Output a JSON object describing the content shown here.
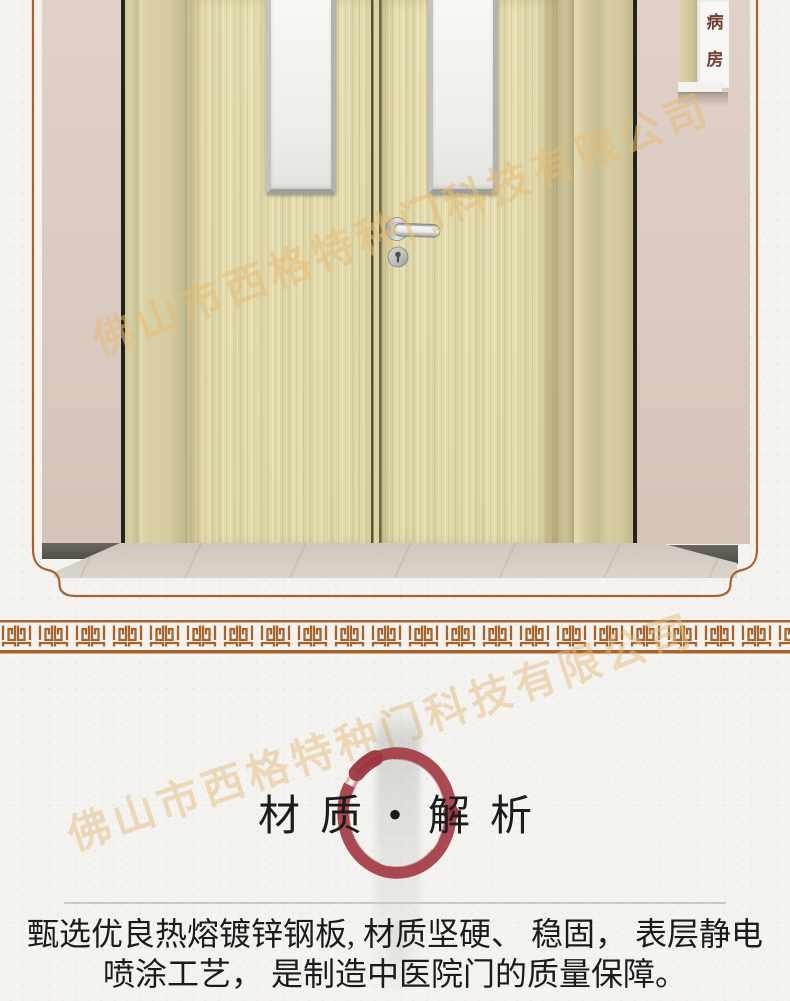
{
  "photo": {
    "room_sign": "病房",
    "watermark_text": "佛山市西格特种门科技有限公司"
  },
  "material_section": {
    "heading_left": "材质",
    "heading_dot": "•",
    "heading_right": "解析",
    "paragraph_line1": "甄选优良热熔镀锌钢板, 材质坚硬、 稳固， 表层静电",
    "paragraph_line2": "喷涂工艺， 是制造中医院门的质量保障。"
  },
  "colors": {
    "paper": "#F5F3F0",
    "border_brown": "#A5642F",
    "meander_brown": "#A4642E",
    "enso_red": "#A33C46",
    "door_leaf": "#E3DBAD",
    "door_frame": "#D5CDA1",
    "wall_pink": "#DACAC1",
    "floor_marble": "#D2CAC1",
    "baseboard_gray": "#5E5B54",
    "glass_white": "#F2F2EF",
    "handle_silver": "#C9C9C7",
    "sign_text_red": "#6F3E37",
    "watermark_gold": "#E5BC77",
    "title_black": "#1C1C1C"
  }
}
